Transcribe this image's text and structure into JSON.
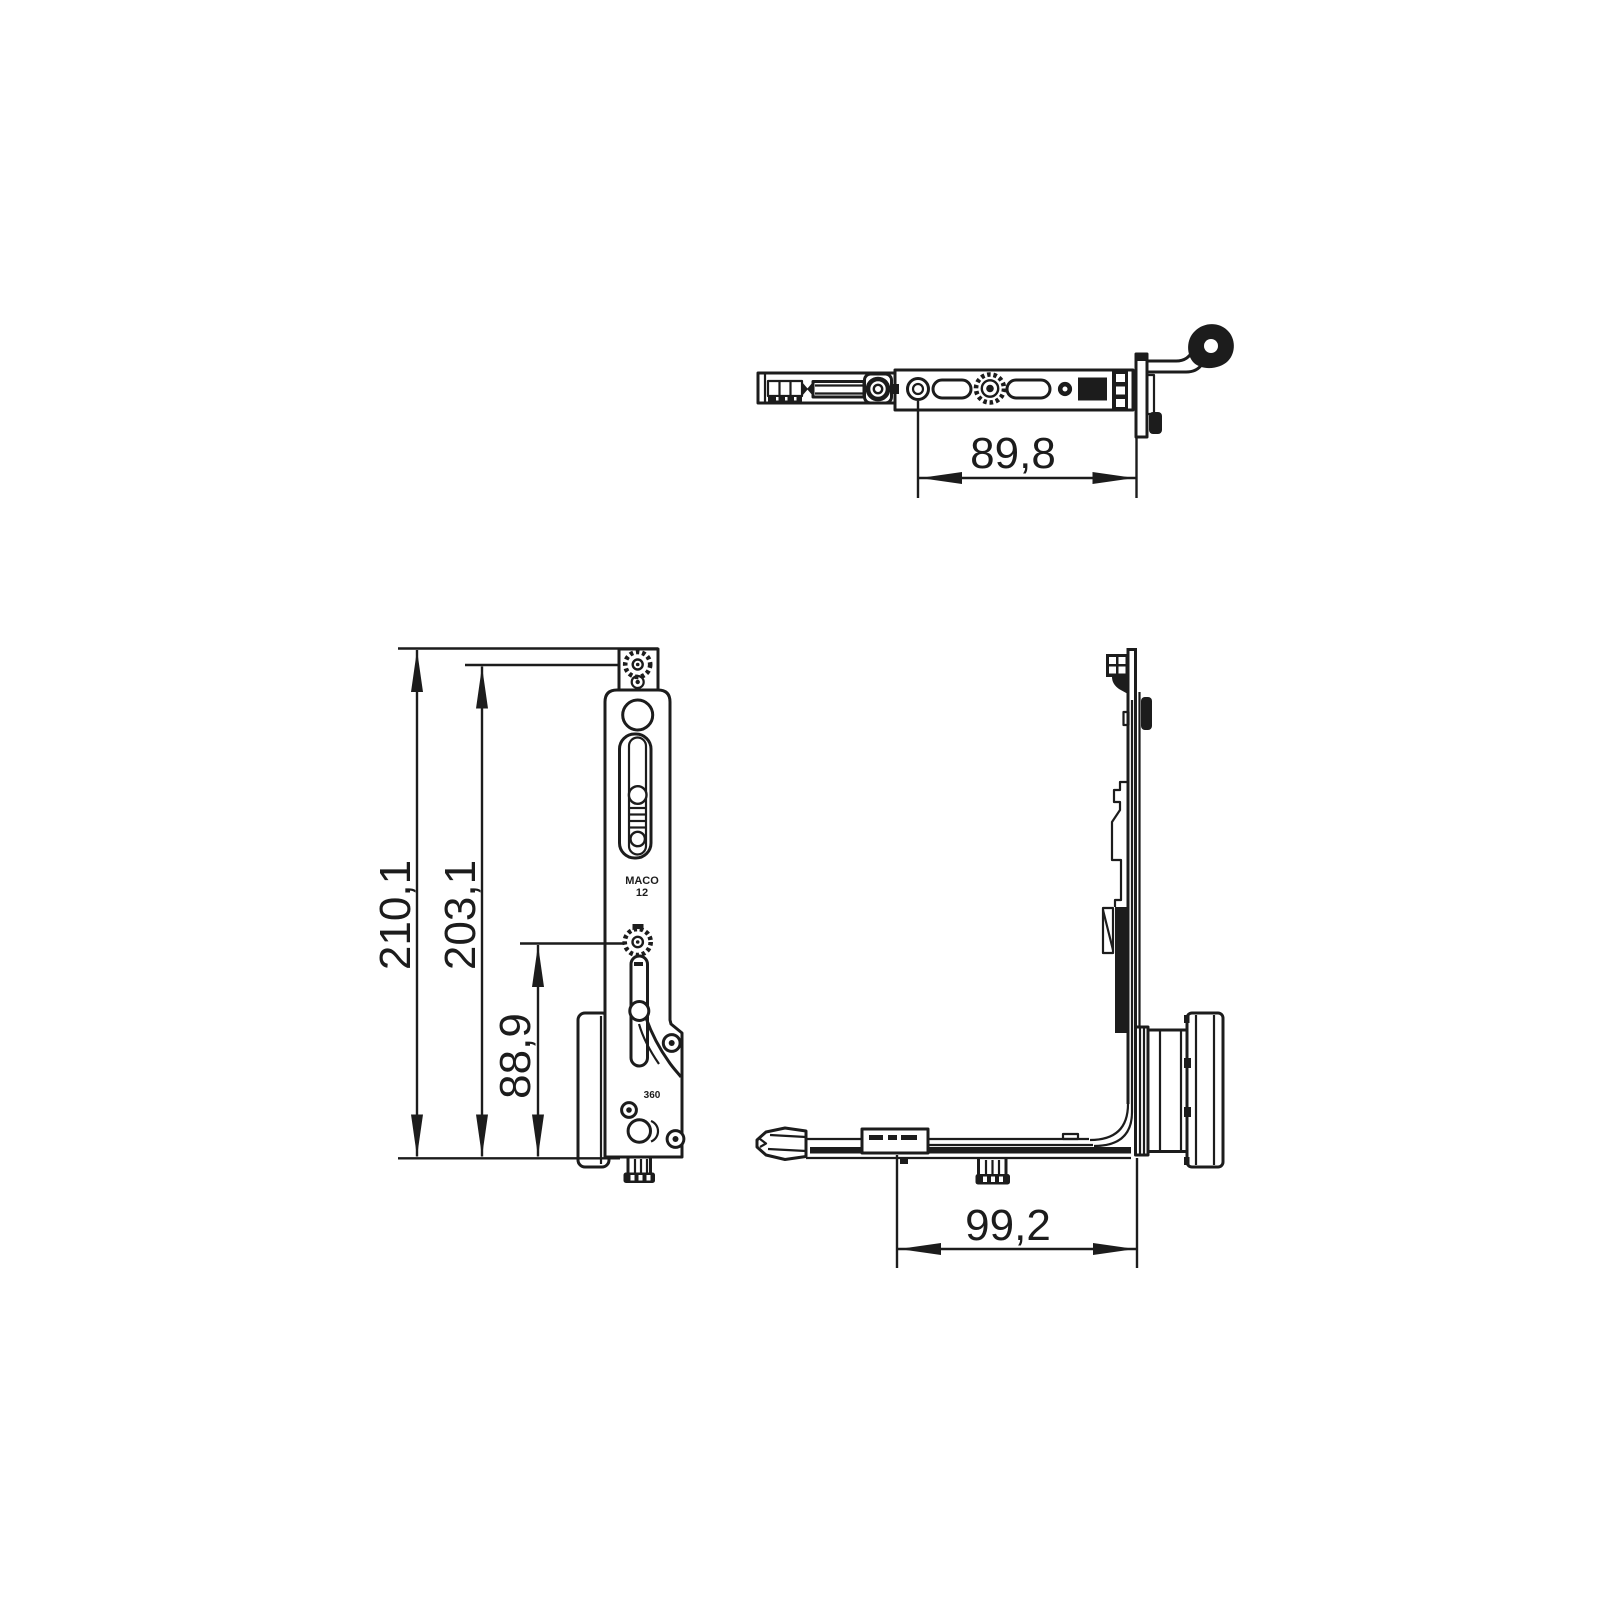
{
  "canvas": {
    "background": "#ffffff",
    "ink": "#1c1c1c"
  },
  "views": {
    "top": {
      "title": "top-view",
      "dimension_width": "89,8"
    },
    "front": {
      "title": "front-view",
      "dimension_overall_height": "210,1",
      "dimension_body_height": "203,1",
      "dimension_lower_height": "88,9",
      "markings": {
        "brand": "MACO",
        "size": "12",
        "model": "360"
      }
    },
    "side": {
      "title": "side-view",
      "dimension_depth": "99,2"
    }
  }
}
